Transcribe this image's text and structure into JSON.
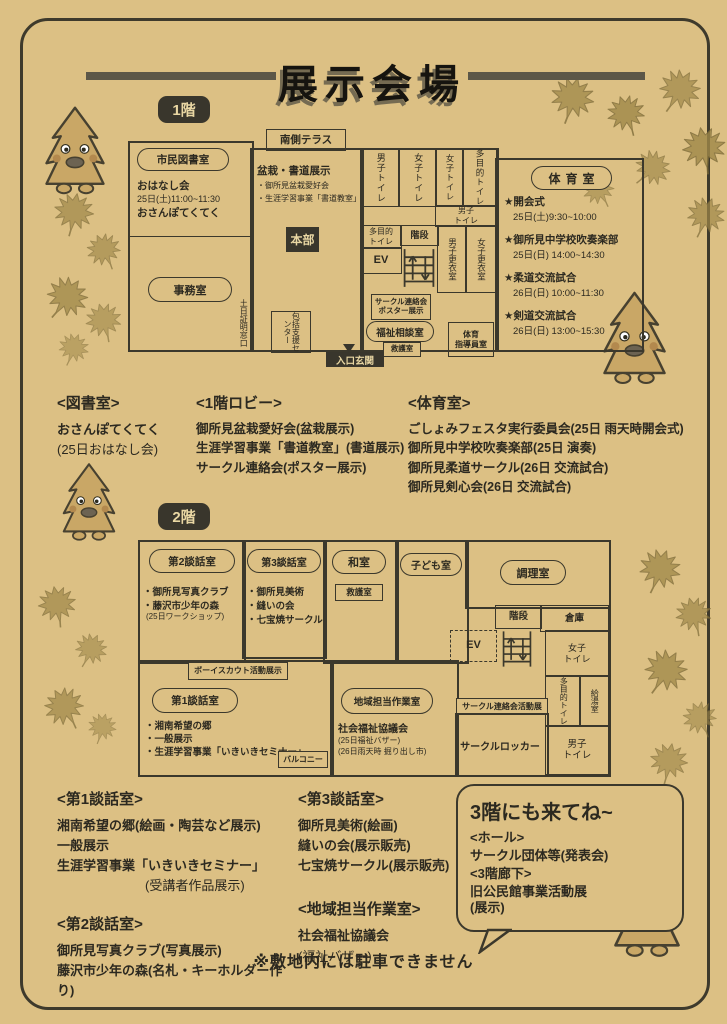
{
  "page": {
    "title": "展示会場",
    "note": "※敷地内には駐車できません"
  },
  "floor1": {
    "badge": "1階",
    "terrace": "南側テラス",
    "library": {
      "label": "市民図書室",
      "line1": "おはなし会",
      "line2": "25日(土)11:00~11:30",
      "line3": "おさんぽてくてく"
    },
    "office": "事務室",
    "weekend_window": "土日証明窓口",
    "support_center": "包括支援センター",
    "bonsai": {
      "title": "盆栽・書道展示",
      "item1": "・御所見盆栽愛好会",
      "item2": "・生涯学習事業「書道教室」"
    },
    "hq": "本部",
    "toilet_m": "男子トイレ",
    "toilet_w1": "女子トイレ",
    "toilet_w2": "女子トイレ",
    "toilet_multi": "多目的トイレ",
    "toilet_m_small": "男子トイレ",
    "toilet_multi_small": "多目的トイレ",
    "stairs": "階段",
    "ev": "EV",
    "locker_m": "男子更衣室",
    "locker_w": "女子更衣室",
    "circle_poster_1": "サークル連絡会",
    "circle_poster_2": "ポスター展示",
    "welfare": "福祉相談室",
    "first_aid": "救護室",
    "pe_room_1": "体育",
    "pe_room_2": "指導員室",
    "entrance": "入口玄関",
    "gym": {
      "label": "体育室",
      "events": [
        {
          "name": "★開会式",
          "time": "25日(土)9:30~10:00"
        },
        {
          "name": "★御所見中学校吹奏楽部",
          "time": "25日(日) 14:00~14:30"
        },
        {
          "name": "★柔道交流試合",
          "time": "26日(日) 10:00~11:30"
        },
        {
          "name": "★剣道交流試合",
          "time": "26日(日) 13:00~15:30"
        }
      ]
    }
  },
  "sections1": {
    "library": {
      "heading": "<図書室>",
      "line1": "おさんぽてくてく",
      "line2": "(25日おはなし会)"
    },
    "lobby": {
      "heading": "<1階ロビー>",
      "line1": "御所見盆栽愛好会(盆栽展示)",
      "line2": "生涯学習事業「書道教室」(書道展示)",
      "line3": "サークル連絡会(ポスター展示)"
    },
    "gym": {
      "heading": "<体育室>",
      "line1": "ごしょみフェスタ実行委員会(25日 雨天時開会式)",
      "line2": "御所見中学校吹奏楽部(25日 演奏)",
      "line3": "御所見柔道サークル(26日 交流試合)",
      "line4": "御所見剣心会(26日 交流試合)"
    }
  },
  "floor2": {
    "badge": "2階",
    "room2": {
      "label": "第2談話室",
      "item1": "・御所見写真クラブ",
      "item2": "・藤沢市少年の森",
      "sub": "(25日ワークショップ)"
    },
    "room3": {
      "label": "第3談話室",
      "item1": "・御所見美術",
      "item2": "・縫いの会",
      "item3": "・七宝焼サークル"
    },
    "washitsu": "和室",
    "first_aid": "救護室",
    "kids": "子ども室",
    "cooking": "調理室",
    "stairs": "階段",
    "storage": "倉庫",
    "ev": "EV",
    "toilet_w": "女子トイレ",
    "toilet_multi": "多目的トイレ",
    "kitchenette": "給湯室",
    "toilet_m": "男子トイレ",
    "scouts": "ボーイスカウト活動展示",
    "room1": {
      "label": "第1談話室",
      "item1": "・湘南希望の郷",
      "item2": "・一般展示",
      "item3": "・生涯学習事業「いきいきセミナー」"
    },
    "balcony": "バルコニー",
    "regional": {
      "label": "地域担当作業室",
      "line1": "社会福祉協議会",
      "line2": "(25日福祉バザー)",
      "line3": "(26日雨天時 掘り出し市)"
    },
    "circle_exhibit": "サークル連絡会活動展",
    "circle_locker": "サークルロッカー"
  },
  "sections2": {
    "room1": {
      "heading": "<第1談話室>",
      "line1": "湘南希望の郷(絵画・陶芸など展示)",
      "line2": "一般展示",
      "line3": "生涯学習事業「いきいきセミナー」",
      "line4": "(受講者作品展示)"
    },
    "room2": {
      "heading": "<第2談話室>",
      "line1": "御所見写真クラブ(写真展示)",
      "line2": "藤沢市少年の森(名札・キーホルダー作り)"
    },
    "room3": {
      "heading": "<第3談話室>",
      "line1": "御所見美術(絵画)",
      "line2": "縫いの会(展示販売)",
      "line3": "七宝焼サークル(展示販売)"
    },
    "regional": {
      "heading": "<地域担当作業室>",
      "line1": "社会福祉協議会",
      "line2": "(福祉バザー)"
    }
  },
  "floor3": {
    "title": "3階にも来てね~",
    "line1": "<ホール>",
    "line2": "サークル団体等(発表会)",
    "line3": "<3階廊下>",
    "line4": "旧公民館事業活動展",
    "line5": "(展示)"
  },
  "colors": {
    "paper": "#dcc084",
    "ink": "#2c2920",
    "wall": "#3b382c",
    "dark_label": "#39362c"
  }
}
